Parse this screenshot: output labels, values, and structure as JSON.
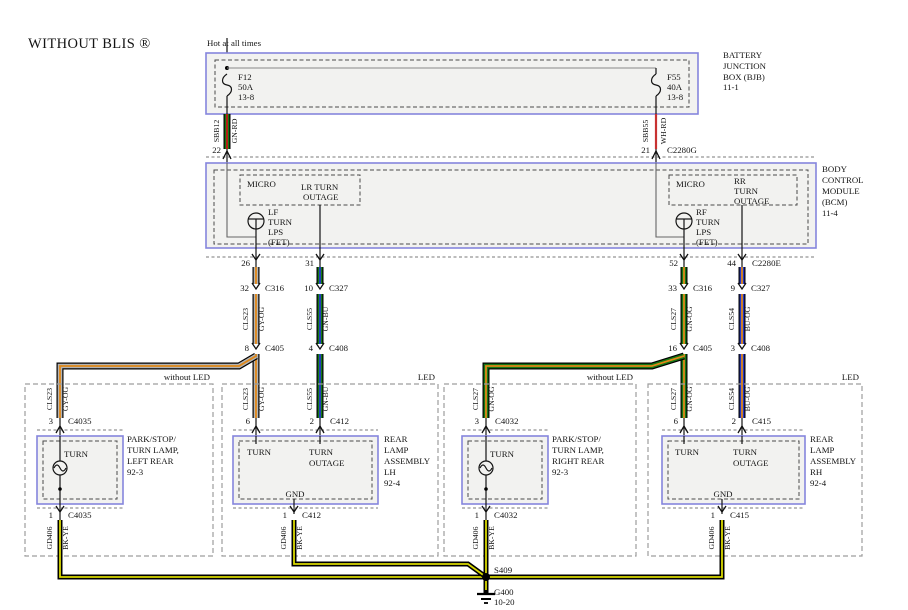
{
  "title": "WITHOUT BLIS ®",
  "top": {
    "hot_label": "Hot at all times"
  },
  "colors": {
    "module_box_stroke": "#8585dd",
    "module_box_fill": "#f2f2f0",
    "wire_green": "#157815",
    "wire_red": "#c81414",
    "wire_orange": "#e08818",
    "wire_gray": "#b4b4b4",
    "wire_blue": "#2437c8",
    "wire_yellow": "#d9d900",
    "wire_black": "#000000"
  },
  "bjb": {
    "name": [
      "BATTERY",
      "JUNCTION",
      "BOX (BJB)",
      "11-1"
    ],
    "f12": [
      "F12",
      "50A",
      "13-8"
    ],
    "f55": [
      "F55",
      "40A",
      "13-8"
    ]
  },
  "bcm": {
    "name": [
      "BODY",
      "CONTROL",
      "MODULE",
      "(BCM)",
      "11-4"
    ],
    "micro_left": "MICRO",
    "micro_right": "MICRO",
    "lr_outage": [
      "LR TURN",
      "OUTAGE"
    ],
    "rr_outage": [
      "RR",
      "TURN",
      "OUTAGE"
    ],
    "lf_fet": [
      "LF",
      "TURN",
      "LPS",
      "(FET)"
    ],
    "rf_fet": [
      "RF",
      "TURN",
      "LPS",
      "(FET)"
    ]
  },
  "wires": {
    "sbb12": {
      "id": "SBB12",
      "color": "GN-RD"
    },
    "sbb55": {
      "id": "SBB55",
      "color": "WH-RD"
    },
    "cls23": {
      "id": "CLS23",
      "color": "GY-OG"
    },
    "cls55": {
      "id": "CLS55",
      "color": "GN-BU"
    },
    "cls27": {
      "id": "CLS27",
      "color": "GN-OG"
    },
    "cls54": {
      "id": "CLS54",
      "color": "BU-OG"
    },
    "gd406": {
      "id": "GD406",
      "color": "BK-YE"
    }
  },
  "pins": {
    "p22": "22",
    "p21": "21",
    "p26": "26",
    "p31": "31",
    "p52": "52",
    "p44": "44",
    "p32": "32",
    "p10": "10",
    "p33": "33",
    "p9": "9",
    "p8": "8",
    "p4": "4",
    "p16": "16",
    "p3": "3",
    "p6": "6",
    "p2": "2",
    "p1": "1"
  },
  "connectors": {
    "c2280g": "C2280G",
    "c2280e": "C2280E",
    "c316": "C316",
    "c327": "C327",
    "c405": "C405",
    "c408": "C408",
    "c4035": "C4035",
    "c412": "C412",
    "c4032": "C4032",
    "c415": "C415"
  },
  "branch_labels": {
    "without_led": "without LED",
    "led": "LED"
  },
  "lamps": {
    "lh_lamp": {
      "name": [
        "PARK/STOP/",
        "TURN LAMP,",
        "LEFT REAR",
        "92-3"
      ],
      "turn": "TURN"
    },
    "lh_assy": {
      "name": [
        "REAR",
        "LAMP",
        "ASSEMBLY",
        "LH",
        "92-4"
      ],
      "turn": "TURN",
      "outage": [
        "TURN",
        "OUTAGE"
      ],
      "gnd": "GND"
    },
    "rh_lamp": {
      "name": [
        "PARK/STOP/",
        "TURN LAMP,",
        "RIGHT REAR",
        "92-3"
      ],
      "turn": "TURN"
    },
    "rh_assy": {
      "name": [
        "REAR",
        "LAMP",
        "ASSEMBLY",
        "RH",
        "92-4"
      ],
      "turn": "TURN",
      "outage": [
        "TURN",
        "OUTAGE"
      ],
      "gnd": "GND"
    }
  },
  "ground": {
    "splice": "S409",
    "name": "G400",
    "ref": "10-20"
  }
}
